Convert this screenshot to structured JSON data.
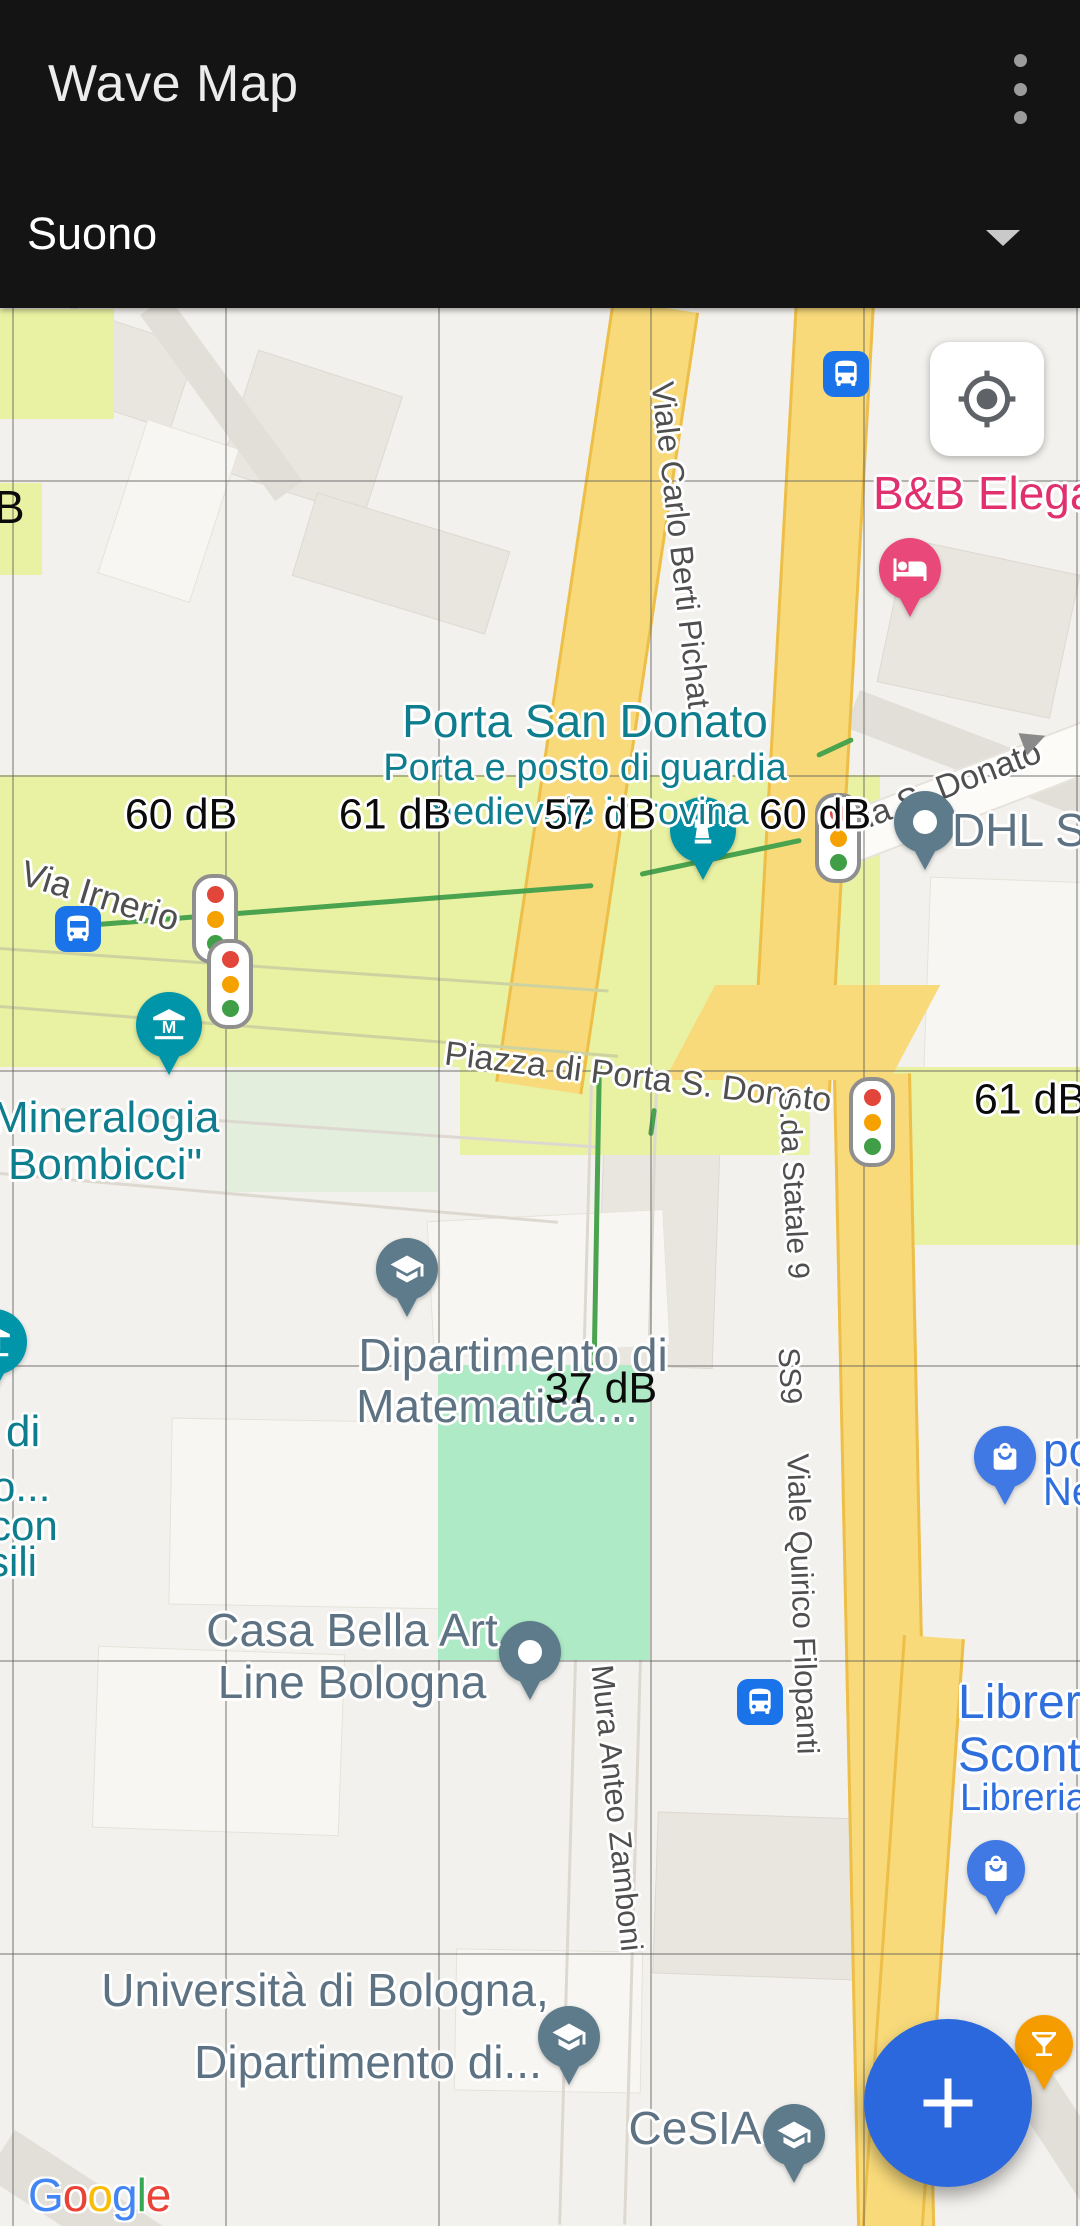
{
  "app": {
    "title": "Wave Map",
    "menu_icon": "overflow-menu",
    "selector": {
      "value": "Suono",
      "icon": "dropdown-arrow"
    }
  },
  "controls": {
    "locate_icon": "my-location",
    "fab_icon": "plus"
  },
  "map": {
    "attribution": {
      "letters": [
        "G",
        "o",
        "o",
        "g",
        "l",
        "e"
      ]
    },
    "db_labels": [
      {
        "text": "60 dB"
      },
      {
        "text": "61 dB"
      },
      {
        "text": "57 dB"
      },
      {
        "text": "60 dB"
      },
      {
        "text": "61 dB"
      },
      {
        "text": "37 dB"
      },
      {
        "text": "B"
      }
    ],
    "streets": {
      "berti_pichat": "Viale Carlo Berti Pichat",
      "via_s_donato": "Via S. Donato",
      "via_irnerio": "Via Irnerio",
      "piazza": "Piazza di Porta S. Donato",
      "statale9": "S.da Statale 9",
      "ss9": "SS9",
      "filopanti": "Viale Quirico Filopanti",
      "zamboni": "Mura Anteo Zamboni"
    },
    "pois": {
      "bnb": {
        "name": "B&B Elegan"
      },
      "porta": {
        "name": "Porta San Donato",
        "sub1": "Porta e posto di guardia",
        "sub2": "medievale in rovina"
      },
      "dhl": {
        "name": "DHL ST"
      },
      "mineralogia": {
        "line1": "Mineralogia",
        "line2": "i Bombicci\""
      },
      "fragments": {
        "l1": "di",
        "l2": "o...",
        "l3": "con",
        "l4": "sili"
      },
      "matematica": {
        "line1": "Dipartimento di",
        "line2": "Matematica…"
      },
      "casa_bella": {
        "line1": "Casa Bella Art",
        "line2": "Line Bologna"
      },
      "universita": {
        "line1": "Università di Bologna,",
        "line2": "Dipartimento di..."
      },
      "cesia": {
        "name": "CeSIA"
      },
      "libreria": {
        "line1": "Libreria",
        "line2": "Sconto",
        "line3": "Libreria"
      },
      "shop": {
        "line1": "po",
        "line2": "Ne"
      }
    },
    "colors": {
      "poi_teal": "#0e7d8e",
      "poi_blue": "#2f6fdd",
      "poi_slate": "#5d7b8a",
      "poi_pink": "#e0306e",
      "zone_lime": "#e9f1a2",
      "zone_mint": "#aeeac6",
      "road_yellow": "#f8da7a",
      "fab_blue": "#2b68dd"
    }
  }
}
